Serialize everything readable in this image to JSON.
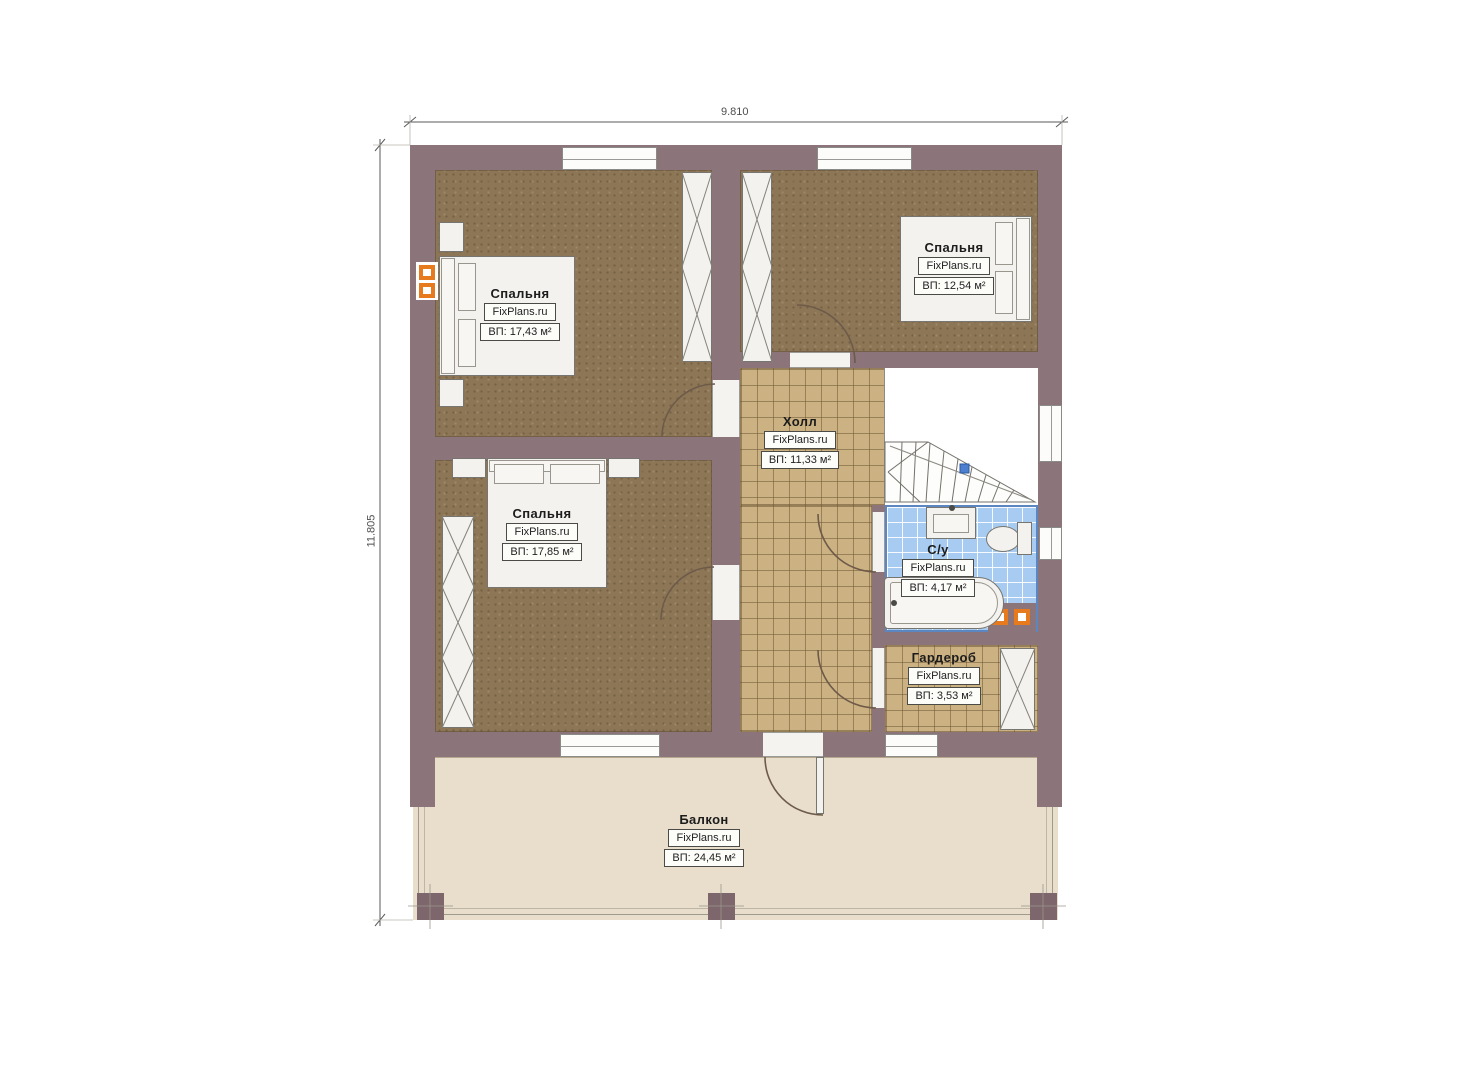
{
  "dimensions": {
    "width": "9.810",
    "height": "11.805"
  },
  "rooms": {
    "bedroom_tl": {
      "name": "Спальня",
      "brand": "FixPlans.ru",
      "area": "ВП: 17,43 м²"
    },
    "bedroom_tr": {
      "name": "Спальня",
      "brand": "FixPlans.ru",
      "area": "ВП: 12,54 м²"
    },
    "bedroom_bl": {
      "name": "Спальня",
      "brand": "FixPlans.ru",
      "area": "ВП: 17,85 м²"
    },
    "hall": {
      "name": "Холл",
      "brand": "FixPlans.ru",
      "area": "ВП: 11,33 м²"
    },
    "bathroom": {
      "name": "С/у",
      "brand": "FixPlans.ru",
      "area": "ВП: 4,17 м²"
    },
    "wardrobe": {
      "name": "Гардероб",
      "brand": "FixPlans.ru",
      "area": "ВП: 3,53 м²"
    },
    "balcony": {
      "name": "Балкон",
      "brand": "FixPlans.ru",
      "area": "ВП: 24,45 м²"
    }
  },
  "colors": {
    "wall": "#8b747a",
    "bedroom_floor": "#8d7656",
    "tile_floor": "#ccb183",
    "bath_tile": "#a8ccf1",
    "balcony_floor": "#e8decb",
    "radiator_accent": "#e87a1e",
    "stair_marker": "#4d7fd0"
  }
}
